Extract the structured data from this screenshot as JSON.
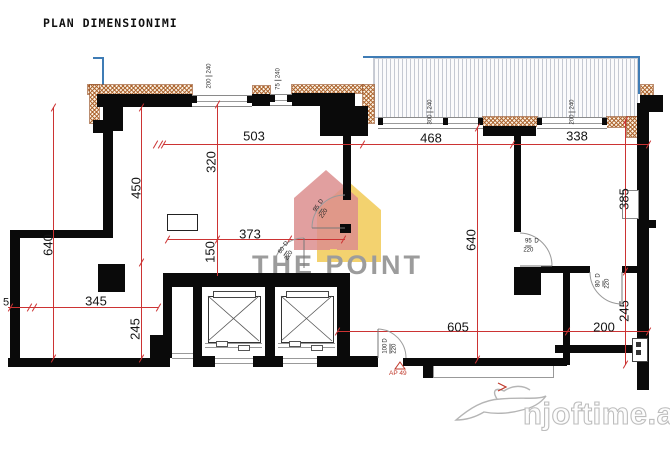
{
  "title": "PLAN DIMENSIONIMI",
  "watermarks": {
    "brand": "THE POINT",
    "site": "njoftime.al"
  },
  "dimensions": {
    "top_left": "503",
    "top_mid": "468",
    "top_right": "338",
    "v320": "320",
    "v450": "450",
    "v640_left": "640",
    "mid373": "373",
    "v150": "150",
    "left345": "345",
    "left5": "5",
    "v245_left": "245",
    "v640_mid": "640",
    "v385": "385",
    "v245_right": "245",
    "bot605": "605",
    "bot200": "200"
  },
  "window_labels": [
    {
      "w": "200",
      "h": "240"
    },
    {
      "w": "75",
      "h": "240"
    },
    {
      "w": "300",
      "h": "240"
    },
    {
      "w": "200",
      "h": "240"
    }
  ],
  "door_labels": [
    {
      "num": "95",
      "den": "220",
      "tag": "D"
    },
    {
      "num": "80",
      "den": "220",
      "tag": "D"
    },
    {
      "num": "95",
      "den": "220",
      "tag": "D"
    },
    {
      "num": "80",
      "den": "220",
      "tag": "D"
    },
    {
      "num": "100",
      "den": "220",
      "tag": "D"
    }
  ],
  "annotations": {
    "ap_ref": "AP 49"
  }
}
